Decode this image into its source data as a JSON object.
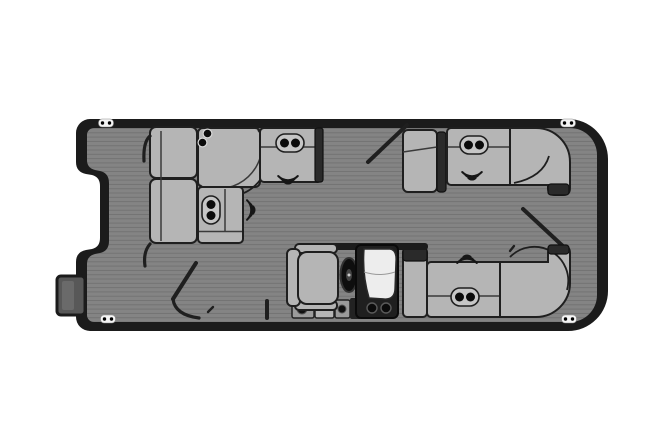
{
  "diagram": {
    "type": "pontoon-boat-floor-plan",
    "view": "top-down",
    "orientation": "horizontal",
    "regions": {
      "bow_group": [
        "side-bench-upper",
        "side-bench-lower",
        "bow-corner-seat",
        "bow-top-bench",
        "bow-return-bench"
      ],
      "helm_group": [
        "captain-chair",
        "steering-wheel",
        "helm-console",
        "windshield",
        "step-boxes"
      ],
      "aft_top_group": [
        "aft-iso-seat",
        "aft-top-bench",
        "aft-top-corner-seat"
      ],
      "aft_bottom_group": [
        "aft-arm-seat",
        "aft-bottom-bench",
        "aft-bottom-corner-seat"
      ],
      "exterior": [
        "boarding-ladder",
        "cleats"
      ]
    },
    "counts": {
      "cleats": 4,
      "speaker_icons": 4,
      "cupholder_pairs": 6,
      "gates": 3,
      "couch_sections": 10
    }
  },
  "colors": {
    "bg": "#ffffff",
    "hull": "#1b1b1b",
    "deck": "#848484",
    "plank": "#6f6f6f",
    "cushion": "#b5b5b5",
    "cushion_light": "#c6c6c6",
    "armrest": "#2a2a2a",
    "seam": "#3a3a3a",
    "line": "#1f1f1f",
    "console": "#1f1f1f",
    "windshield": "#ededed",
    "wheel": "#0e0e0e",
    "ladder": "#585858",
    "cleat": "#f4f4f4",
    "dot": "#0b0b0b"
  },
  "cleats": [
    {
      "x": 106,
      "y": 123
    },
    {
      "x": 568,
      "y": 123
    },
    {
      "x": 108,
      "y": 319
    },
    {
      "x": 569,
      "y": 319
    }
  ],
  "speakers": [
    {
      "x": 288,
      "y": 181,
      "rot": 180
    },
    {
      "x": 252,
      "y": 210,
      "rot": 90
    },
    {
      "x": 472,
      "y": 177,
      "rot": 180
    },
    {
      "x": 467,
      "y": 258,
      "rot": 0
    }
  ],
  "cup_holders": [
    {
      "x": 290,
      "y": 143,
      "style": "pill",
      "rot": 0
    },
    {
      "x": 211,
      "y": 210,
      "style": "pill",
      "rot": 90
    },
    {
      "x": 474,
      "y": 145,
      "style": "pill",
      "rot": 0
    },
    {
      "x": 465,
      "y": 297,
      "style": "pill",
      "rot": 0
    },
    {
      "x": 205,
      "y": 138,
      "style": "dots",
      "rot": 0
    },
    {
      "x": 379,
      "y": 308,
      "style": "dark",
      "rot": 0
    }
  ]
}
